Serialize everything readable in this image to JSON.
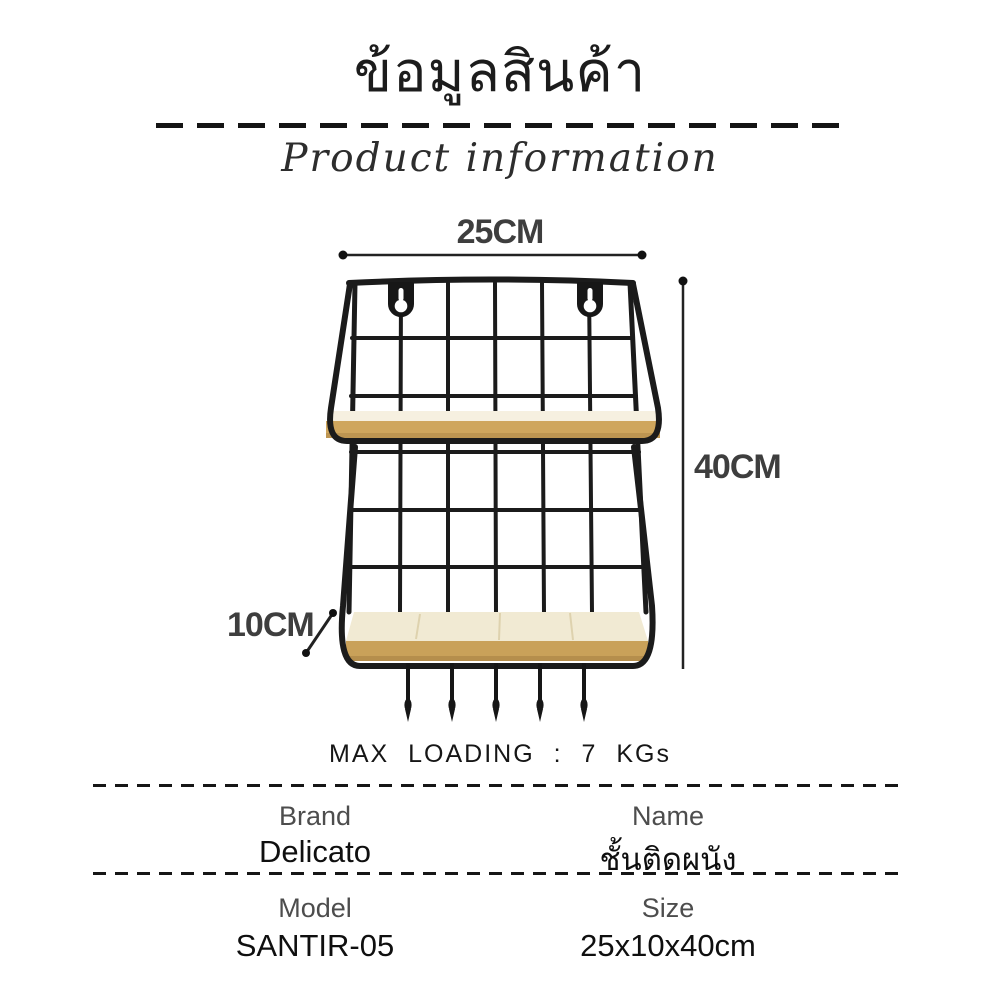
{
  "header": {
    "title_thai": "ข้อมูลสินค้า",
    "subtitle": "Product information"
  },
  "diagram": {
    "width_label": "25CM",
    "height_label": "40CM",
    "depth_label": "10CM",
    "max_loading": "MAX LOADING : 7 KGs",
    "hook_count": 5,
    "hanger_count": 2,
    "shelf_count": 2
  },
  "specs": {
    "rows": [
      {
        "left_label": "Brand",
        "left_value": "Delicato",
        "right_label": "Name",
        "right_value": "ชั้นติดผนัง"
      },
      {
        "left_label": "Model",
        "left_value": "SANTIR-05",
        "right_label": "Size",
        "right_value": "25x10x40cm"
      }
    ]
  },
  "colors": {
    "wire": "#1b1b1b",
    "wood_top_light": "#f6f0e0",
    "wood_top_lower": "#f1ead3",
    "wood_front": "#cfa65d",
    "dimension_text": "#3e3e3e",
    "dash_line": "#141414"
  }
}
